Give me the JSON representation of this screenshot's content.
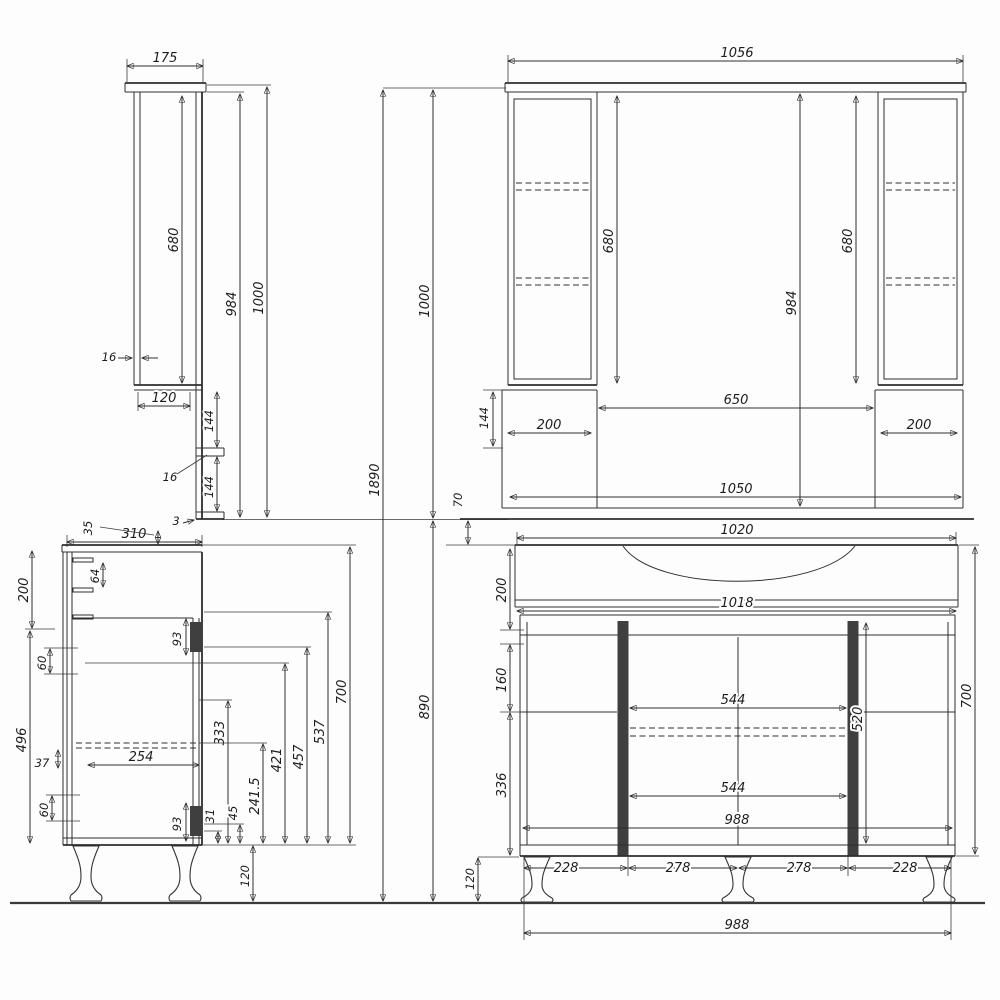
{
  "mirror_side": {
    "depth": "175",
    "door_height": "680",
    "inner_height": "984",
    "total_height": "1000",
    "panel_thickness": "16",
    "shelf_depth": "120",
    "upper_gap": "144",
    "shelf_thickness": "16",
    "lower_gap": "144",
    "bottom_lip": "3"
  },
  "mirror_front": {
    "top_width": "1056",
    "left_cabinet_height": "680",
    "right_cabinet_height": "680",
    "inner_height": "984",
    "center_opening_width": "650",
    "left_cabinet_width": "200",
    "right_cabinet_width": "200",
    "side_box_height": "144",
    "bottom_width": "1050"
  },
  "overall": {
    "total_height": "1890",
    "mirror_unit_height": "1000",
    "vanity_unit_height": "890",
    "overlap_gap": "70"
  },
  "vanity_front": {
    "top_width": "1020",
    "counter_width": "1018",
    "top_section_height": "200",
    "drawer_section_height": "160",
    "door_section_height": "336",
    "upper_opening_width": "544",
    "lower_opening_width": "544",
    "door_height": "520",
    "carcass_width": "988",
    "leg_spacings": [
      "228",
      "278",
      "278",
      "228"
    ],
    "leg_height": "120",
    "bottom_width": "988",
    "side_height": "700"
  },
  "vanity_side": {
    "depth": "310",
    "top_lip": "35",
    "hook_spacing": "64",
    "top_section_height": "200",
    "upper_gap": "60",
    "body_height": "496",
    "rail_offset": "37",
    "lower_gap": "60",
    "drawer_depth": "254",
    "upper_hinge": "93",
    "lower_hinge": "93",
    "dim_333": "333",
    "dim_241_5": "241.5",
    "dim_31": "31",
    "dim_45": "45",
    "dim_421": "421",
    "dim_457": "457",
    "dim_537": "537",
    "dim_700": "700",
    "leg_height": "120"
  }
}
